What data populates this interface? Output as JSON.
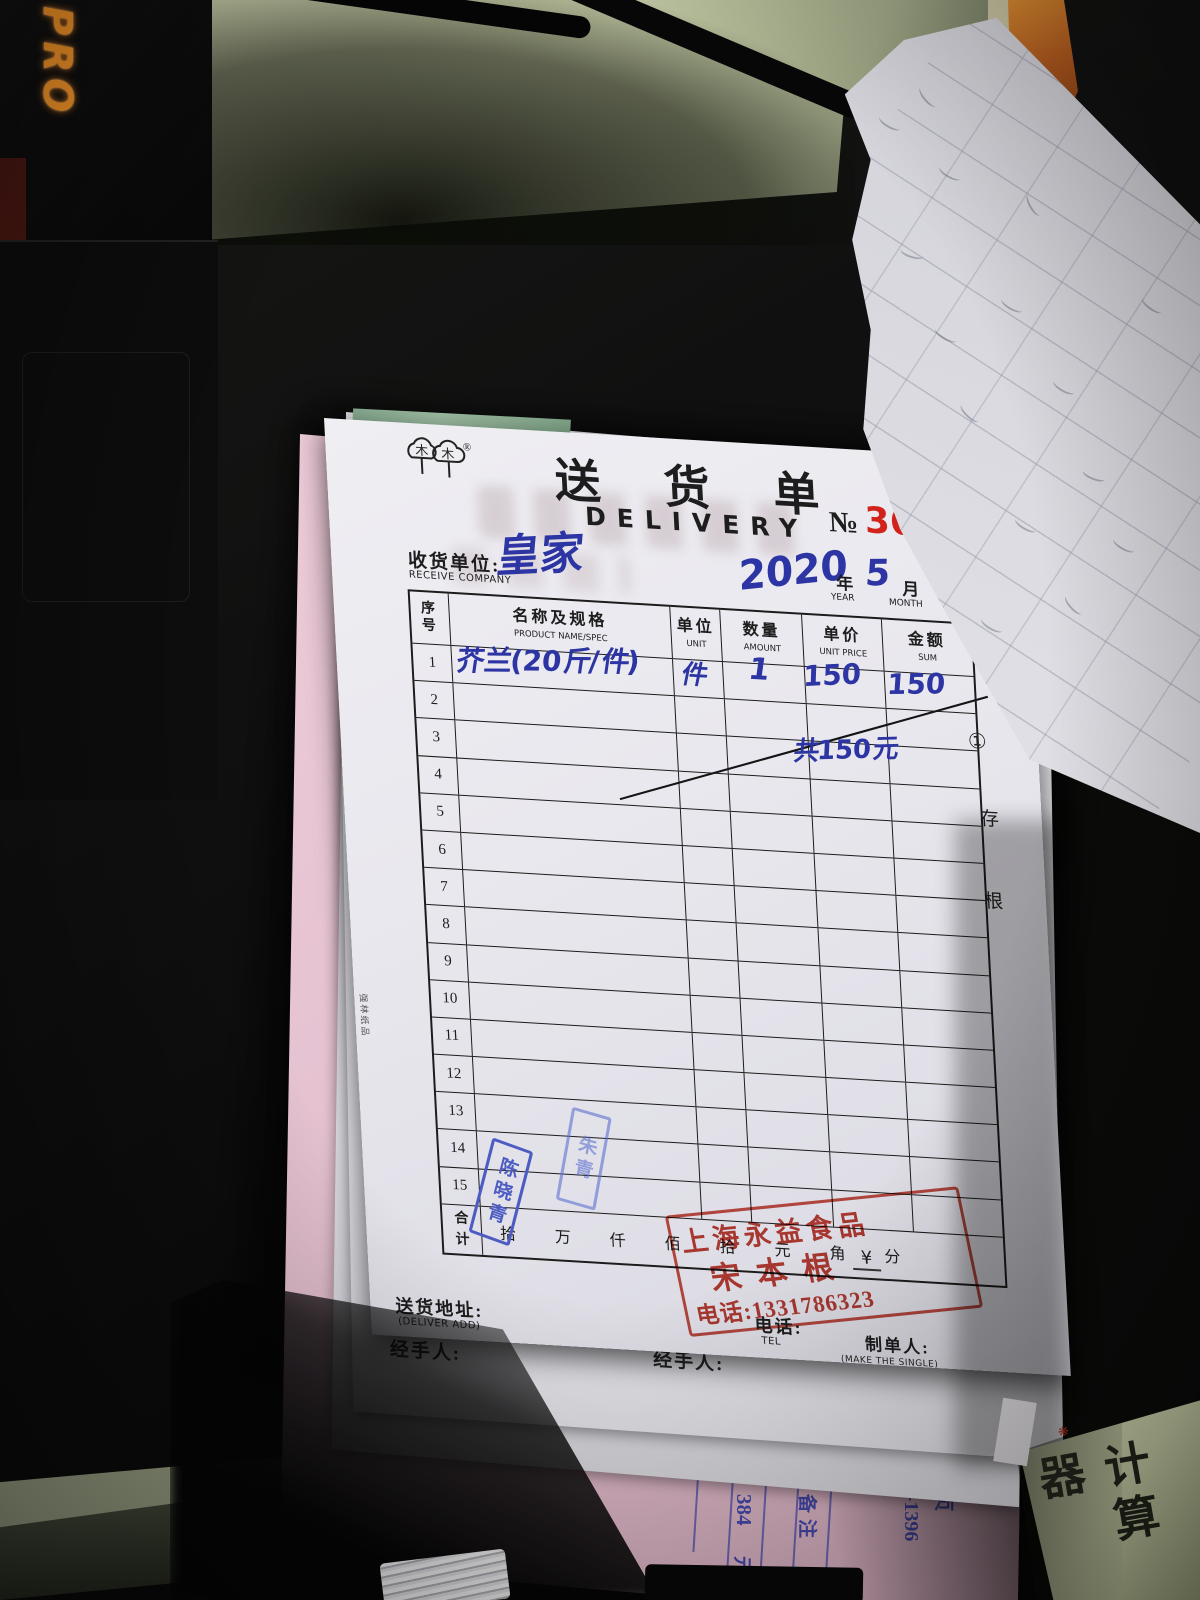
{
  "sheet": {
    "logo": {
      "chars": "木木",
      "registered": "®"
    },
    "title_cn": "送 货 单",
    "title_en": "DELIVERY",
    "no_prefix": "№",
    "no_value": "36",
    "receiver": {
      "label_cn": "收货单位:",
      "label_en": "RECEIVE COMPANY",
      "value": "皇家"
    },
    "date": {
      "year": "2020",
      "year_cn": "年",
      "year_en": "YEAR",
      "month": "5",
      "month_cn": "月",
      "month_en": "MONTH",
      "day": "21"
    },
    "table": {
      "headers": [
        {
          "cn": "序号",
          "en": ""
        },
        {
          "cn": "名称及规格",
          "en": "PRODUCT NAME/SPEC"
        },
        {
          "cn": "单位",
          "en": "UNIT"
        },
        {
          "cn": "数量",
          "en": "AMOUNT"
        },
        {
          "cn": "单价",
          "en": "UNIT PRICE"
        },
        {
          "cn": "金额",
          "en": "SUM"
        }
      ],
      "col_widths": [
        39,
        222,
        50,
        82,
        80,
        88
      ],
      "row_numbers": [
        "1",
        "2",
        "3",
        "4",
        "5",
        "6",
        "7",
        "8",
        "9",
        "10",
        "11",
        "12",
        "13",
        "14",
        "15"
      ],
      "entry": {
        "name": "芥兰(20斤/件)",
        "unit": "件",
        "amount": "1",
        "price": "150",
        "sum": "150"
      },
      "note": "共150元",
      "total_cn": "合计",
      "amount_units": [
        "拾",
        "万",
        "仟",
        "佰",
        "拾",
        "元",
        "角",
        "分"
      ],
      "currency": "¥"
    },
    "footer": {
      "address_cn": "送货地址:",
      "address_en": "(DELIVER ADD)",
      "tel_cn": "电话:",
      "tel_en": "TEL",
      "maker_cn": "制单人:",
      "maker_en": "(MAKE THE SINGLE)"
    },
    "margin": {
      "copy_no": "①",
      "copy_char_1": "存",
      "copy_char_2": "根"
    },
    "printer_mark": "强林纸品",
    "red_stamp": {
      "line1": "上海永益食品",
      "line2": "宋本根",
      "line3": "电话:1331786323"
    },
    "blue_stamp_1": "陈晓青",
    "blue_stamp_2": "朱青",
    "handler_label": "经手人:"
  },
  "surroundings": {
    "device_label": "PRO",
    "pink_form": {
      "partial": "4",
      "qty": "384",
      "unit": "元",
      "remark": "备注",
      "code": "05-28-1396",
      "page": "第1/1页"
    },
    "package_text": "计算器"
  }
}
